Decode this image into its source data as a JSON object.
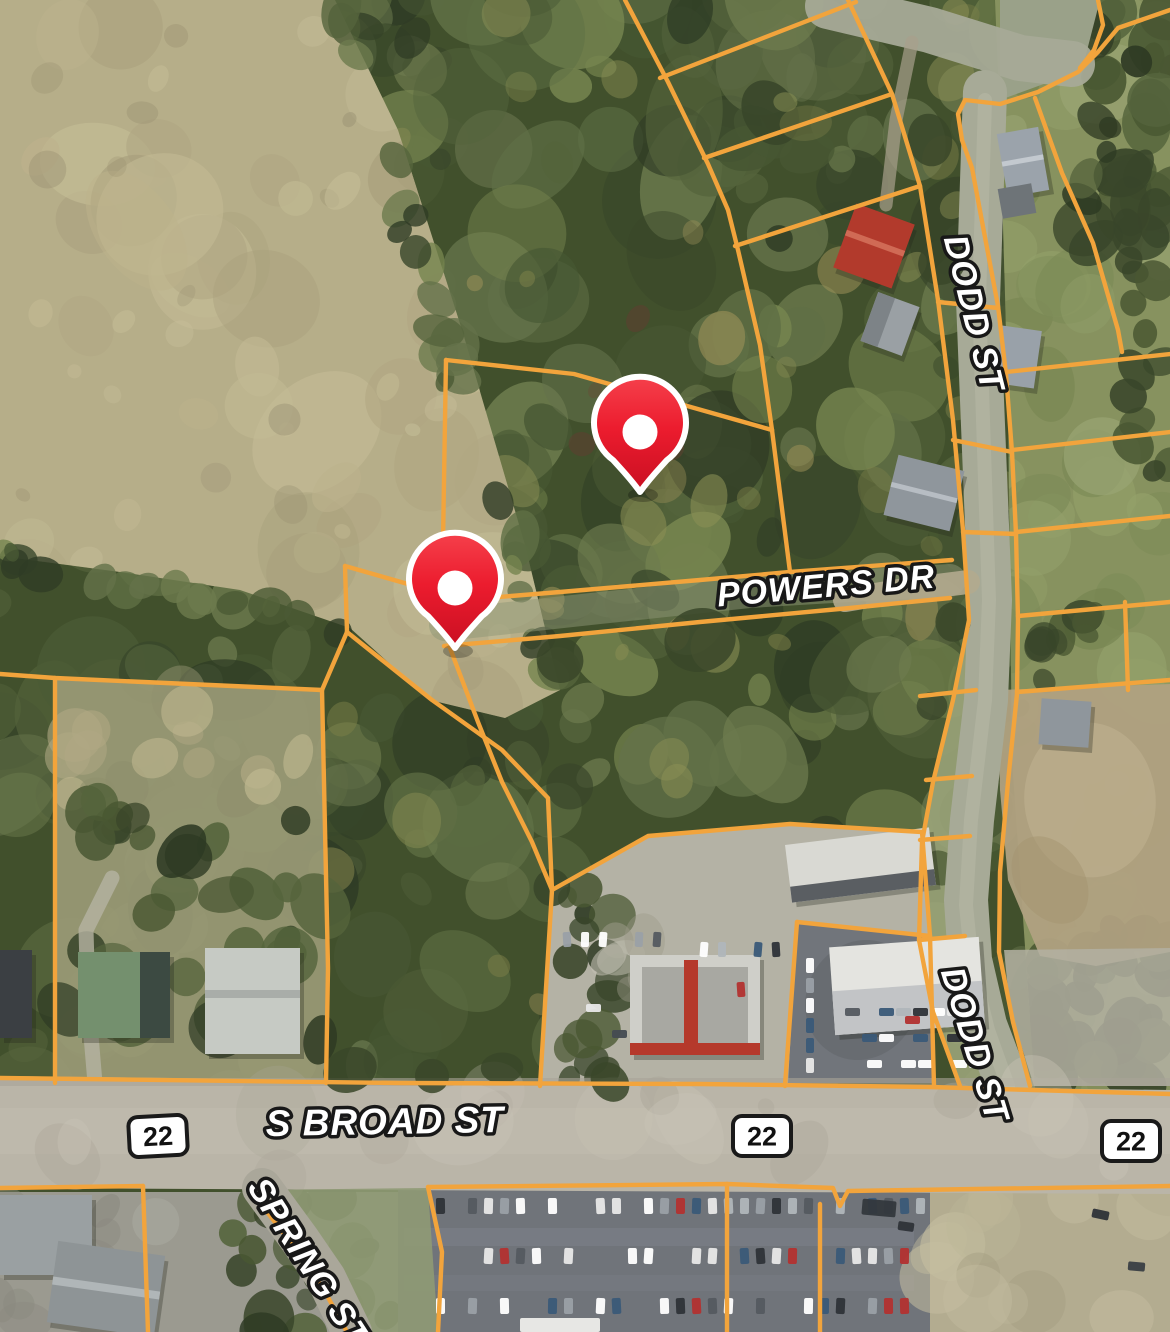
{
  "map": {
    "description": "Aerial parcel map with property pins",
    "road_labels": [
      {
        "text": "DODD ST",
        "x": 963,
        "y": 316,
        "rotation": 76,
        "size": 34
      },
      {
        "text": "POWERS DR",
        "x": 827,
        "y": 597,
        "rotation": -5,
        "size": 34
      },
      {
        "text": "DODD ST",
        "x": 964,
        "y": 1048,
        "rotation": 73,
        "size": 34
      },
      {
        "text": "S BROAD ST",
        "x": 385,
        "y": 1134,
        "rotation": -1,
        "size": 37
      },
      {
        "text": "SPRING ST",
        "x": 299,
        "y": 1268,
        "rotation": 57,
        "size": 34
      }
    ],
    "route_shields": [
      {
        "text": "22",
        "x": 158,
        "y": 1136,
        "rotation": -3
      },
      {
        "text": "22",
        "x": 762,
        "y": 1136,
        "rotation": 0
      },
      {
        "text": "22",
        "x": 1131,
        "y": 1141,
        "rotation": 0
      }
    ],
    "markers": [
      {
        "name": "property-pin-1",
        "tip_x": 640,
        "tip_y": 492
      },
      {
        "name": "property-pin-2",
        "tip_x": 455,
        "tip_y": 648
      }
    ],
    "colors": {
      "parcel_line": "#F2A43C",
      "marker_fill": "#EC1C2E",
      "marker_fill_dark": "#C90F22",
      "marker_stroke": "#FFFFFF",
      "label_fill": "#FFFFFF",
      "label_stroke": "#181818",
      "shield_fill": "#FFFFFF",
      "shield_border": "#1A1A1A",
      "shield_text": "#111111"
    }
  }
}
